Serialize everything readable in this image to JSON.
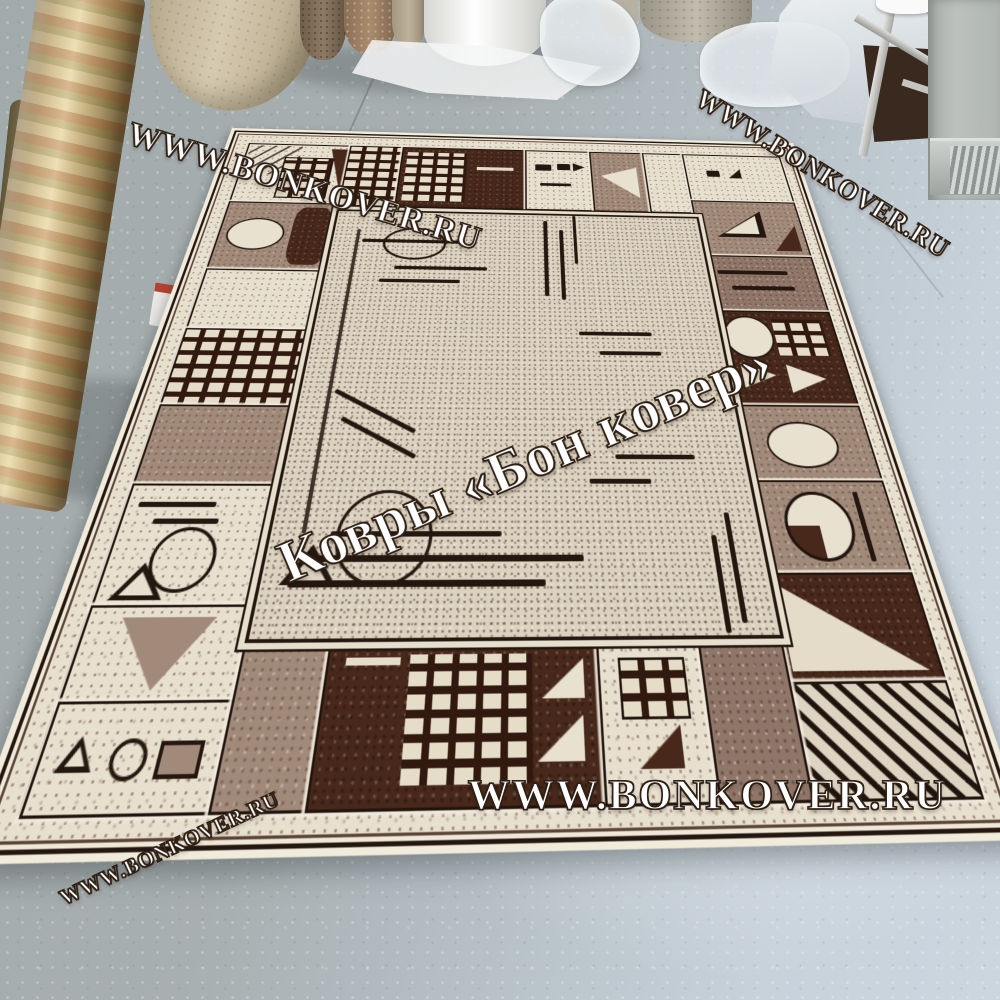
{
  "watermarks": {
    "site_url": "WWW.BONKOVER.RU",
    "brand_caption": "Ковры «Бон ковер»"
  },
  "palette": {
    "floor_concrete": "#a8b0b2",
    "floor_light_blue": "#c8d2db",
    "rug_cream": "#e8e0cf",
    "rug_field": "#dbd2c0",
    "rug_taupe": "#a18a7a",
    "rug_mauve": "#8f7668",
    "rug_chocolate": "#47281a",
    "rug_line_black": "#20140d",
    "watermark_fill": "#ffffff"
  }
}
